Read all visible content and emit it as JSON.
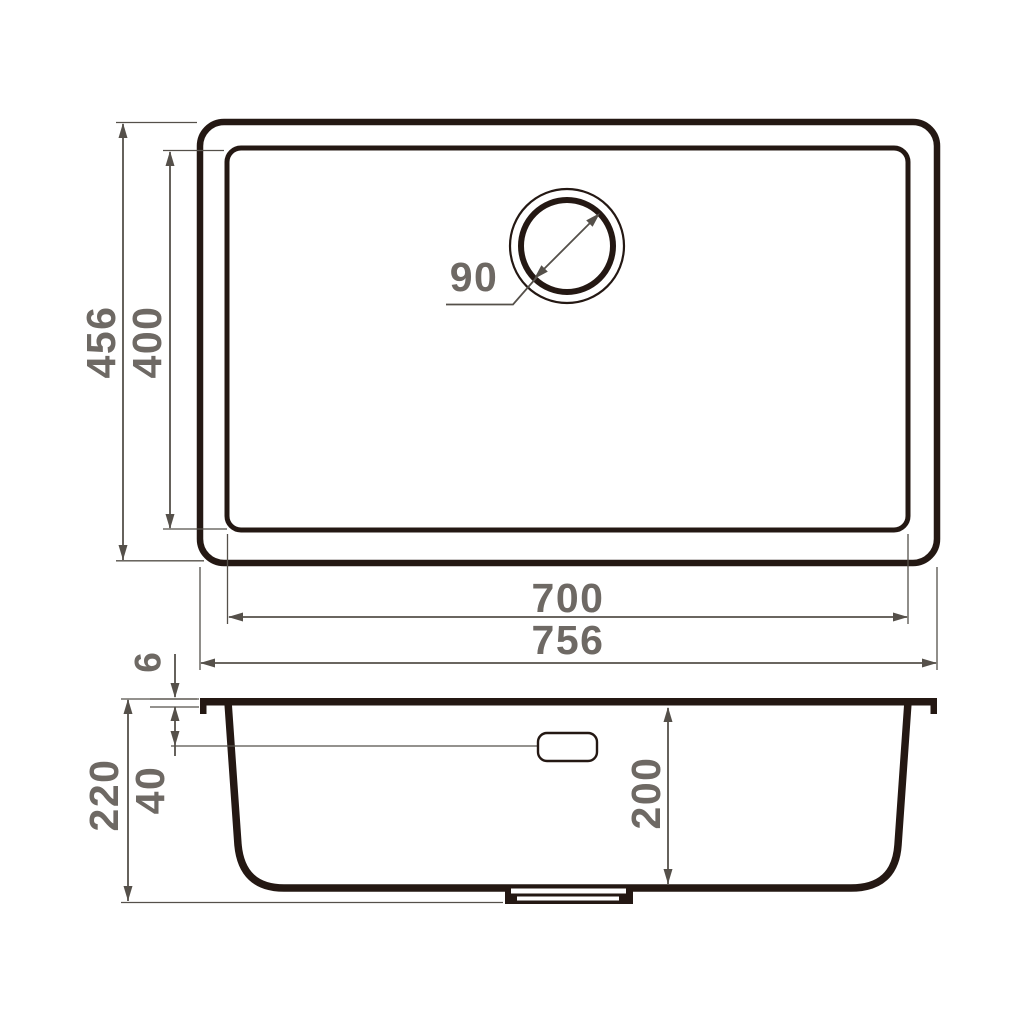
{
  "drawing_type": "sink dimensional drawing, top view and cross-section",
  "colors": {
    "outline": "#241813",
    "dimension": "#55504a",
    "label": "#6e6964",
    "background": "#ffffff"
  },
  "top_view": {
    "labels": {
      "outer_depth": "456",
      "bowl_depth": "400",
      "drain_diameter": "90",
      "bowl_width": "700",
      "outer_width": "756"
    }
  },
  "section_view": {
    "labels": {
      "rim_thickness": "6",
      "total_height": "220",
      "overflow_offset": "40",
      "bowl_inner_depth": "200"
    }
  }
}
